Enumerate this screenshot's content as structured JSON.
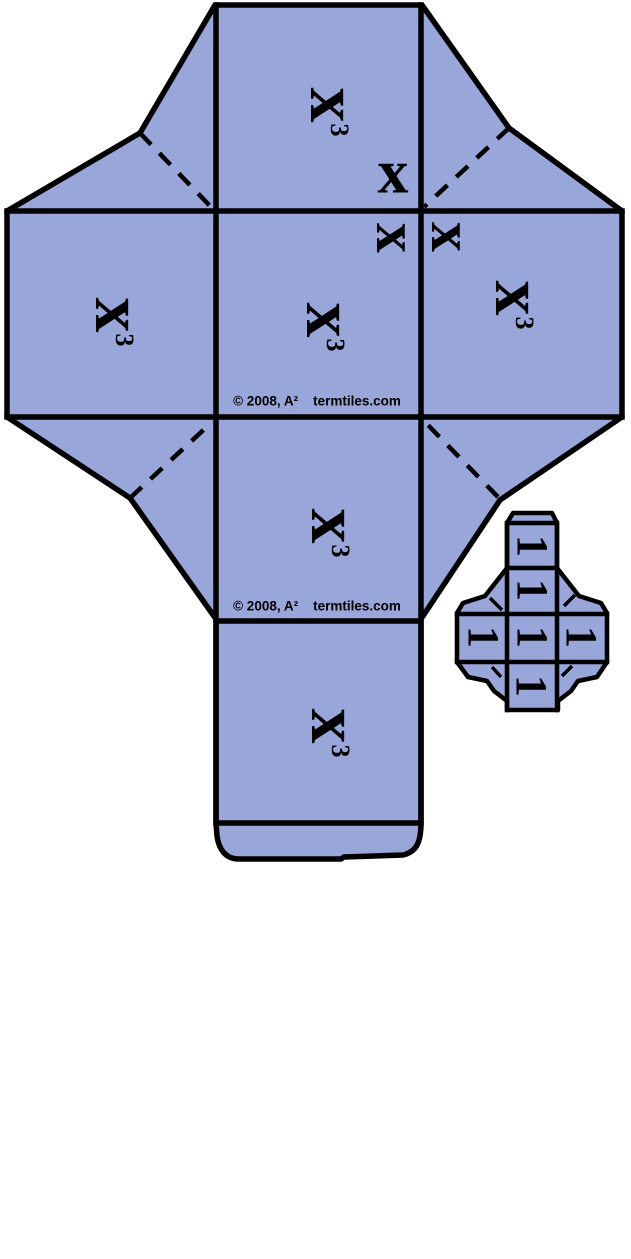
{
  "canvas": {
    "width": 631,
    "height": 1259,
    "background": "#FFFFFF"
  },
  "large_net": {
    "name": "x-cubed cube fold-up template",
    "tile_fill": "#99A6D9",
    "line_color": "#000000",
    "face_label": {
      "base": "x",
      "exp": "3"
    },
    "edge_labels": {
      "top_face_edge": "x",
      "center_face_corner": "x",
      "right_face_corner": "x"
    },
    "copyright": {
      "owner": "© 2008, A²",
      "site": "termtiles.com"
    }
  },
  "small_net": {
    "name": "unit tile fold-up template",
    "tile_fill": "#99A6D9",
    "line_color": "#000000",
    "faces": [
      {
        "label": "1"
      },
      {
        "label": "1"
      },
      {
        "label": "1"
      },
      {
        "label": "1"
      },
      {
        "label": "1"
      },
      {
        "label": "1"
      }
    ]
  }
}
